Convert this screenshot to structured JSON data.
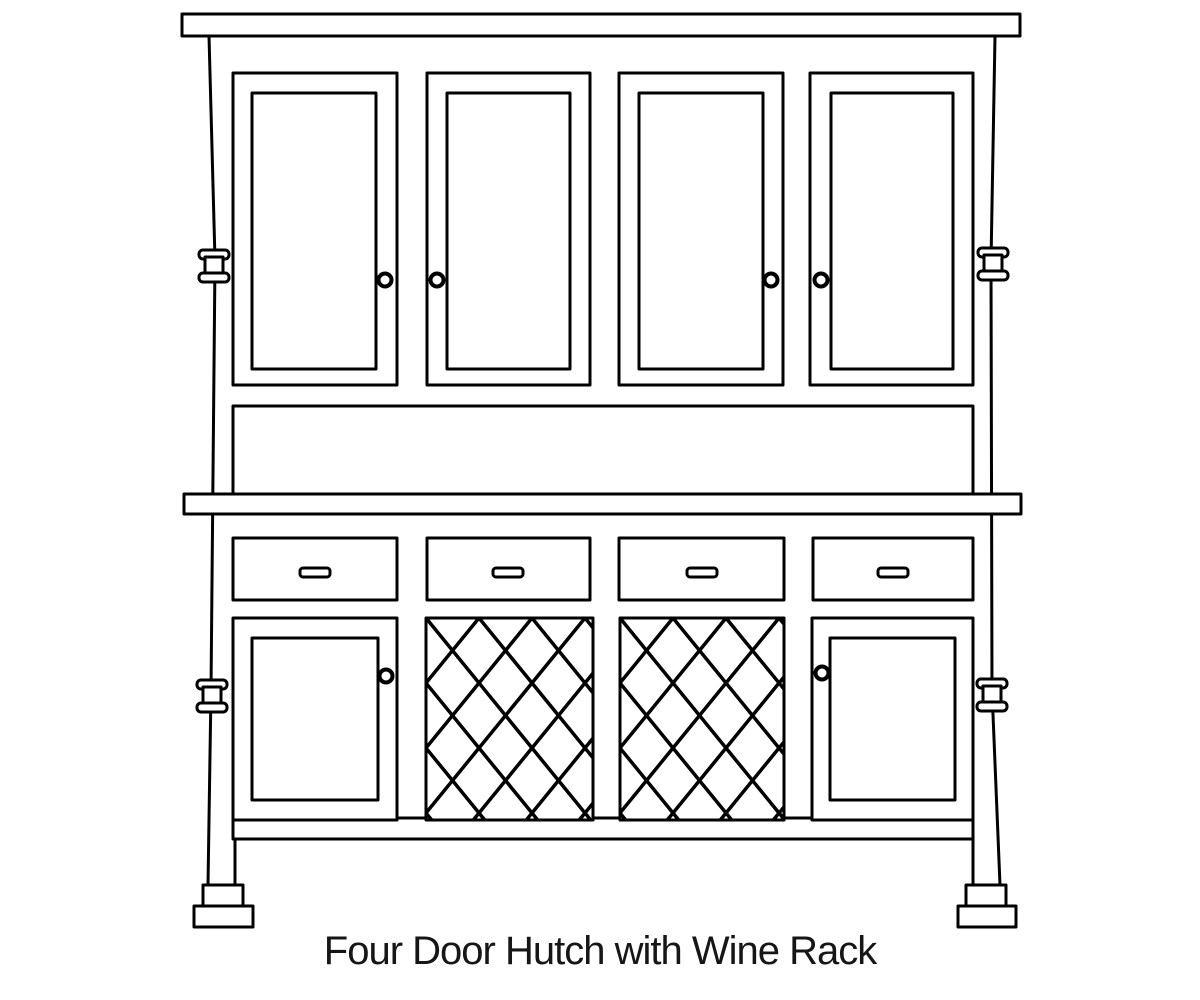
{
  "page": {
    "background_color": "#ffffff"
  },
  "diagram": {
    "caption": "Four Door Hutch with Wine Rack",
    "line_color": "#000000",
    "fill_color": "#ffffff",
    "components": {
      "upper_doors": 4,
      "upper_door_knobs": 4,
      "drawers": 4,
      "drawer_handles": 4,
      "wine_racks": 2,
      "lower_doors": 2,
      "lower_door_knobs": 2,
      "side_spools": 4,
      "feet": 2
    }
  }
}
